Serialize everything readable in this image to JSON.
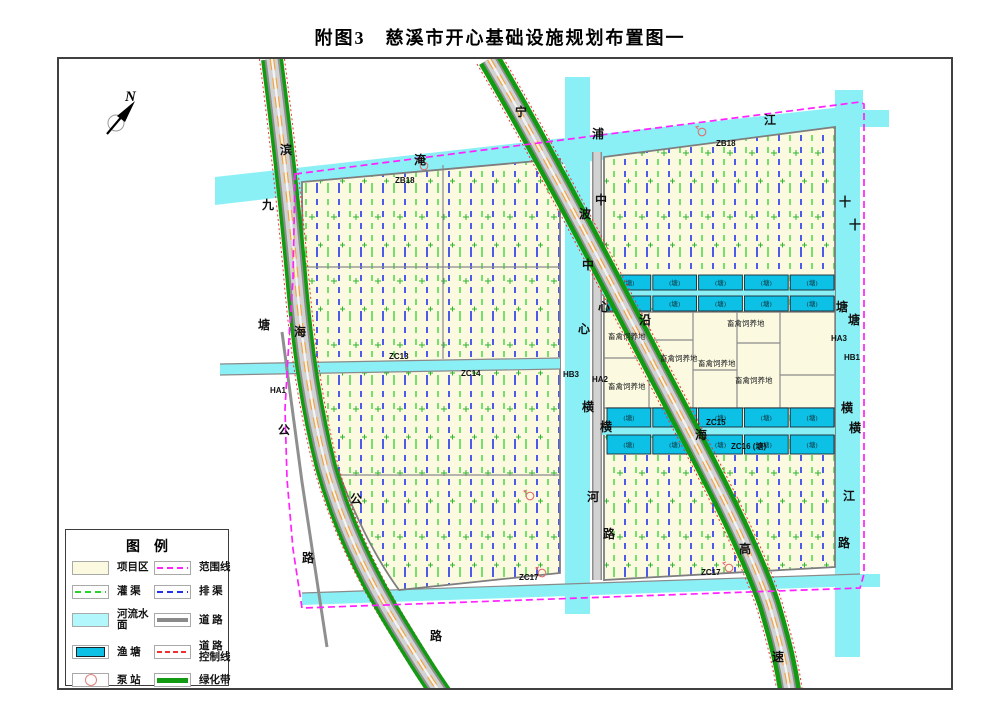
{
  "page_title": "附图3　慈溪市开心基础设施规划布置图一",
  "compass_label": "N",
  "colors": {
    "farm": "#fbfae1",
    "river": "#8af0f6",
    "pond": "#0cc0e6",
    "boundary": "#ff22ff",
    "irrigation": "#2ed22e",
    "drain": "#2233e8",
    "control": "#f03030",
    "greenbelt": "#129a12",
    "center_line": "#f5a23c"
  },
  "legend": {
    "title": "图例",
    "items_left": [
      {
        "key": "project-area",
        "label": "项目区"
      },
      {
        "key": "irrigation-canal",
        "label": "灌  渠"
      },
      {
        "key": "river-surface",
        "label": "河流水面"
      },
      {
        "key": "fish-pond",
        "label": "渔  塘"
      },
      {
        "key": "pump-station",
        "label": "泵  站"
      }
    ],
    "items_right": [
      {
        "key": "boundary-line",
        "label": "范围线"
      },
      {
        "key": "drain-canal",
        "label": "排  渠"
      },
      {
        "key": "road",
        "label": "道  路"
      },
      {
        "key": "road-control-line",
        "label": "道 路\n控制线"
      },
      {
        "key": "green-belt",
        "label": "绿化带"
      }
    ]
  },
  "map": {
    "pond_label": "(塘)",
    "labels": [
      {
        "t": "滨",
        "x": 221,
        "y": 95,
        "c": "cjk"
      },
      {
        "t": "海",
        "x": 235,
        "y": 277,
        "c": "cjk"
      },
      {
        "t": "公",
        "x": 291,
        "y": 444,
        "c": "cjk"
      },
      {
        "t": "路",
        "x": 371,
        "y": 581,
        "c": "cjk"
      },
      {
        "t": "九",
        "x": 203,
        "y": 150,
        "c": "cjk"
      },
      {
        "t": "塘",
        "x": 199,
        "y": 270,
        "c": "cjk"
      },
      {
        "t": "公",
        "x": 219,
        "y": 375,
        "c": "cjk"
      },
      {
        "t": "路",
        "x": 243,
        "y": 503,
        "c": "cjk"
      },
      {
        "t": "宁",
        "x": 456,
        "y": 57,
        "c": "cjk"
      },
      {
        "t": "波",
        "x": 520,
        "y": 159,
        "c": "cjk"
      },
      {
        "t": "沿",
        "x": 580,
        "y": 265,
        "c": "cjk"
      },
      {
        "t": "海",
        "x": 636,
        "y": 380,
        "c": "cjk"
      },
      {
        "t": "高",
        "x": 680,
        "y": 494,
        "c": "cjk"
      },
      {
        "t": "速",
        "x": 713,
        "y": 602,
        "c": "cjk"
      },
      {
        "t": "淹",
        "x": 355,
        "y": 105,
        "c": "cjk"
      },
      {
        "t": "浦",
        "x": 533,
        "y": 79,
        "c": "cjk"
      },
      {
        "t": "江",
        "x": 705,
        "y": 65,
        "c": "cjk"
      },
      {
        "t": "中",
        "x": 523,
        "y": 210,
        "c": "cjk"
      },
      {
        "t": "心",
        "x": 519,
        "y": 274,
        "c": "cjk"
      },
      {
        "t": "横",
        "x": 523,
        "y": 352,
        "c": "cjk"
      },
      {
        "t": "河",
        "x": 528,
        "y": 442,
        "c": "cjk"
      },
      {
        "t": "中",
        "x": 536,
        "y": 145,
        "c": "cjk"
      },
      {
        "t": "心",
        "x": 539,
        "y": 252,
        "c": "cjk"
      },
      {
        "t": "横",
        "x": 541,
        "y": 372,
        "c": "cjk"
      },
      {
        "t": "路",
        "x": 544,
        "y": 479,
        "c": "cjk"
      },
      {
        "t": "十",
        "x": 780,
        "y": 147,
        "c": "cjk"
      },
      {
        "t": "塘",
        "x": 777,
        "y": 252,
        "c": "cjk"
      },
      {
        "t": "横",
        "x": 782,
        "y": 353,
        "c": "cjk"
      },
      {
        "t": "江",
        "x": 784,
        "y": 441,
        "c": "cjk"
      },
      {
        "t": "十",
        "x": 790,
        "y": 170,
        "c": "cjk"
      },
      {
        "t": "塘",
        "x": 789,
        "y": 265,
        "c": "cjk"
      },
      {
        "t": "横",
        "x": 790,
        "y": 373,
        "c": "cjk"
      },
      {
        "t": "路",
        "x": 779,
        "y": 488,
        "c": "cjk"
      },
      {
        "t": "ZB18",
        "x": 336,
        "y": 124,
        "c": "code"
      },
      {
        "t": "ZB18",
        "x": 657,
        "y": 87,
        "c": "code"
      },
      {
        "t": "ZC13",
        "x": 330,
        "y": 300,
        "c": "code"
      },
      {
        "t": "ZC14",
        "x": 402,
        "y": 317,
        "c": "code"
      },
      {
        "t": "HA1",
        "x": 211,
        "y": 334,
        "c": "code"
      },
      {
        "t": "HB3",
        "x": 504,
        "y": 318,
        "c": "code"
      },
      {
        "t": "HA2",
        "x": 533,
        "y": 323,
        "c": "code"
      },
      {
        "t": "HA3",
        "x": 772,
        "y": 282,
        "c": "code"
      },
      {
        "t": "HB1",
        "x": 785,
        "y": 301,
        "c": "code"
      },
      {
        "t": "ZC15",
        "x": 647,
        "y": 366,
        "c": "code"
      },
      {
        "t": "ZC16 (塘)",
        "x": 672,
        "y": 390,
        "c": "code"
      },
      {
        "t": "ZC17",
        "x": 460,
        "y": 521,
        "c": "code"
      },
      {
        "t": "ZC17",
        "x": 642,
        "y": 516,
        "c": "code"
      },
      {
        "t": "畜禽饲养地",
        "x": 549,
        "y": 280,
        "c": "area"
      },
      {
        "t": "畜禽饲养地",
        "x": 549,
        "y": 330,
        "c": "area"
      },
      {
        "t": "畜禽饲养地",
        "x": 601,
        "y": 302,
        "c": "area"
      },
      {
        "t": "畜禽饲养地",
        "x": 639,
        "y": 307,
        "c": "area"
      },
      {
        "t": "畜禽饲养地",
        "x": 668,
        "y": 267,
        "c": "area"
      },
      {
        "t": "畜禽饲养地",
        "x": 676,
        "y": 324,
        "c": "area"
      }
    ],
    "pond_rows": [
      {
        "x": 548,
        "y": 216,
        "w": 227,
        "h": 15,
        "count": 5
      },
      {
        "x": 548,
        "y": 237,
        "w": 227,
        "h": 15,
        "count": 5
      },
      {
        "x": 548,
        "y": 349,
        "w": 227,
        "h": 19,
        "count": 5
      },
      {
        "x": 548,
        "y": 376,
        "w": 227,
        "h": 19,
        "count": 5
      }
    ],
    "pumps": [
      {
        "x": 365,
        "y": 107
      },
      {
        "x": 643,
        "y": 73
      },
      {
        "x": 483,
        "y": 514
      },
      {
        "x": 670,
        "y": 509
      },
      {
        "x": 471,
        "y": 437
      }
    ]
  }
}
